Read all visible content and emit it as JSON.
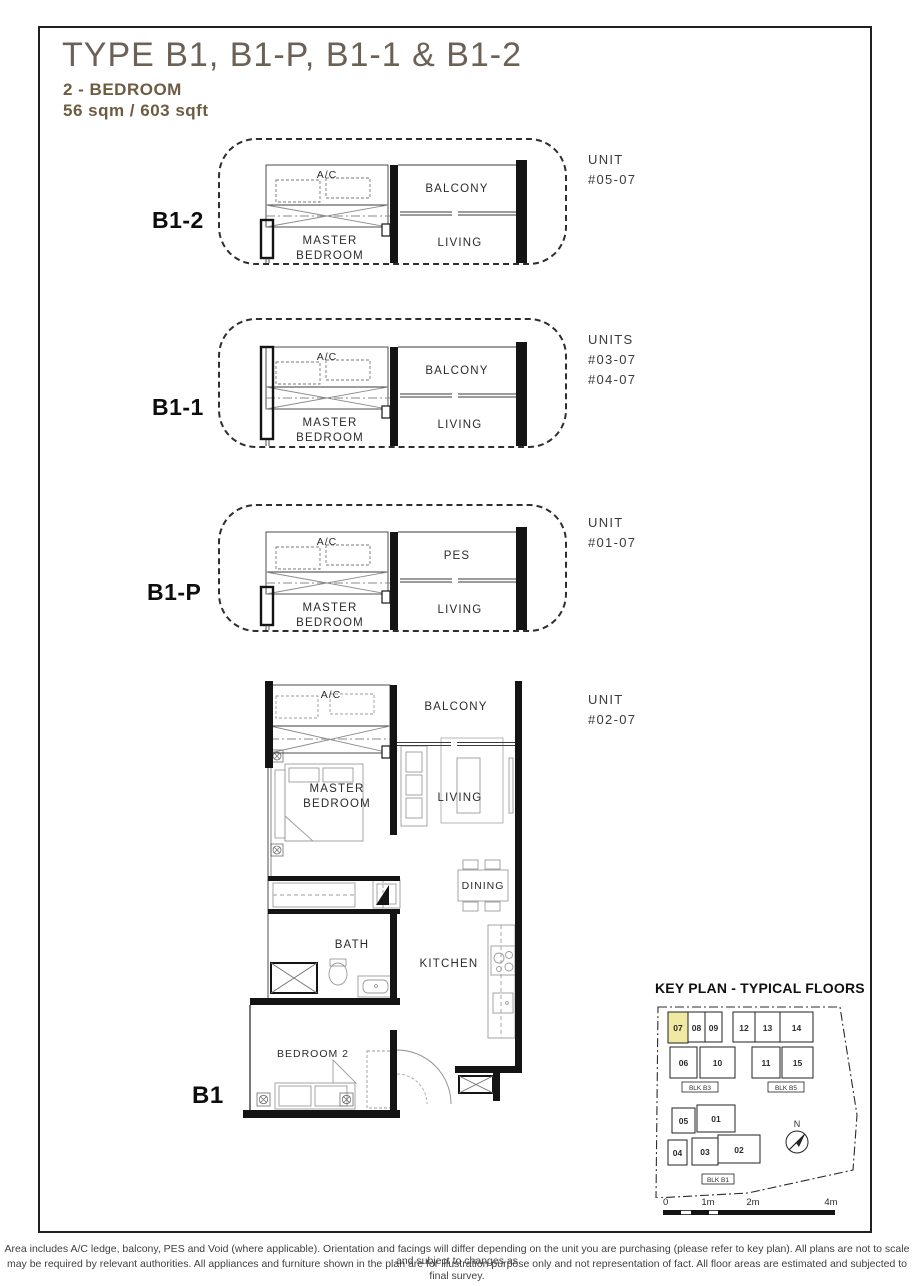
{
  "page": {
    "title": "TYPE B1, B1-P, B1-1 & B1-2",
    "subtitle": "2 - BEDROOM",
    "area": "56 sqm / 603 sqft",
    "title_color": "#6d6156",
    "subtitle_color": "#6d5c41"
  },
  "plans": {
    "b1_2": {
      "label": "B1-2",
      "unit_heading": "UNIT",
      "units": [
        "#05-07"
      ],
      "rooms": {
        "ac": "A/C",
        "outdoor": "BALCONY",
        "master1": "MASTER",
        "master2": "BEDROOM",
        "living": "LIVING"
      }
    },
    "b1_1": {
      "label": "B1-1",
      "unit_heading": "UNITS",
      "units": [
        "#03-07",
        "#04-07"
      ],
      "rooms": {
        "ac": "A/C",
        "outdoor": "BALCONY",
        "master1": "MASTER",
        "master2": "BEDROOM",
        "living": "LIVING"
      }
    },
    "b1_p": {
      "label": "B1-P",
      "unit_heading": "UNIT",
      "units": [
        "#01-07"
      ],
      "rooms": {
        "ac": "A/C",
        "outdoor": "PES",
        "master1": "MASTER",
        "master2": "BEDROOM",
        "living": "LIVING"
      }
    },
    "b1": {
      "label": "B1",
      "unit_heading": "UNIT",
      "units": [
        "#02-07"
      ],
      "rooms": {
        "ac": "A/C",
        "balcony": "BALCONY",
        "master1": "MASTER",
        "master2": "BEDROOM",
        "living": "LIVING",
        "dining": "DINING",
        "bath": "BATH",
        "kitchen": "KITCHEN",
        "bedroom2": "BEDROOM 2"
      }
    }
  },
  "keyplan": {
    "title": "KEY PLAN - TYPICAL FLOORS",
    "highlight_color": "#efe9a2",
    "highlighted_unit": "07",
    "north": "N",
    "blk_b3": "BLK B3",
    "blk_b5": "BLK B5",
    "blk_b1": "BLK B1",
    "u07": "07",
    "u08": "08",
    "u09": "09",
    "u12": "12",
    "u13": "13",
    "u14": "14",
    "u06": "06",
    "u10": "10",
    "u11": "11",
    "u15": "15",
    "u05": "05",
    "u01": "01",
    "u04": "04",
    "u03": "03",
    "u02": "02"
  },
  "scalebar": {
    "labels": [
      "0",
      "1m",
      "2m",
      "4m"
    ]
  },
  "footer": {
    "line1": "Area includes A/C ledge, balcony, PES and Void (where applicable). Orientation and facings will differ depending on the unit you are purchasing (please refer to key plan). All plans are not to scale and subject to changes as",
    "line2": "may be required by relevant authorities. All appliances and furniture shown in the plan are for illustration purpose only and not representation of fact. All floor areas are estimated and subjected to final survey."
  }
}
